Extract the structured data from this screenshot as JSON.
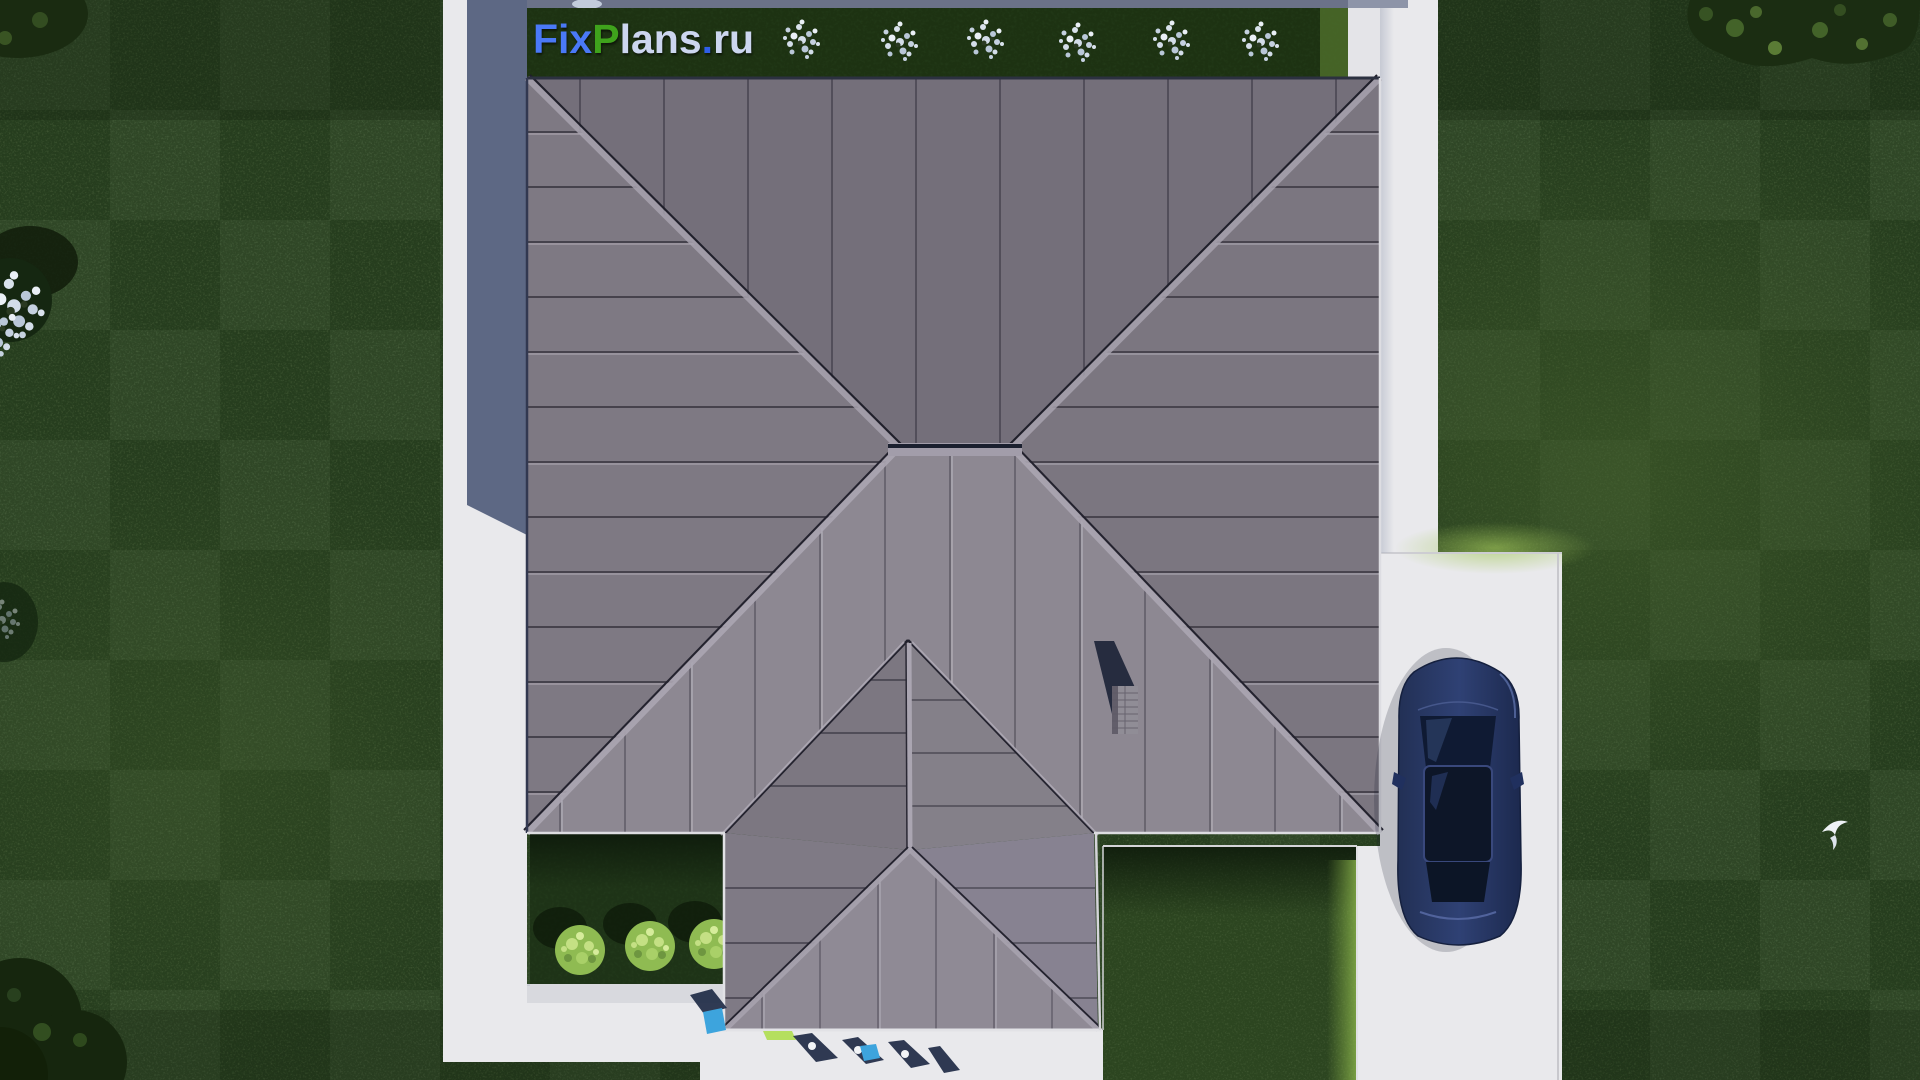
{
  "watermark": {
    "full_text": "FixPlans.ru",
    "segments": [
      {
        "text": "Fix",
        "color": "#4a79f7"
      },
      {
        "text": "P",
        "color": "#3fa31c"
      },
      {
        "text": "lans",
        "color": "#ccd6ef"
      },
      {
        "text": ".",
        "color": "#2f5fe8"
      },
      {
        "text": "ru",
        "color": "#ccd6ef"
      }
    ]
  },
  "scene": {
    "colors": {
      "grass": "#28401f",
      "hedge": "#1d3212",
      "roof_north": "#746f7a",
      "roof_west": "#7e7983",
      "roof_east": "#7b7680",
      "roof_south": "#8d8892",
      "dormer_left": "#7c7781",
      "dormer_right": "#848089",
      "porch_west": "#7f7a85",
      "porch_east": "#878291",
      "porch_south": "#8f8a95",
      "path": "#e9e9ec",
      "shadow_blue": "#5d6884",
      "car_body": "#2f4174",
      "car_glass": "#0f1a33",
      "garden_bush": "#8fbb52",
      "flower_bush": "#d3dde9",
      "pot_blue": "#3da4dd",
      "mat_green": "#b5df5f"
    },
    "hedge_flower_bush_count": 6,
    "garden_bush_count": 3
  }
}
